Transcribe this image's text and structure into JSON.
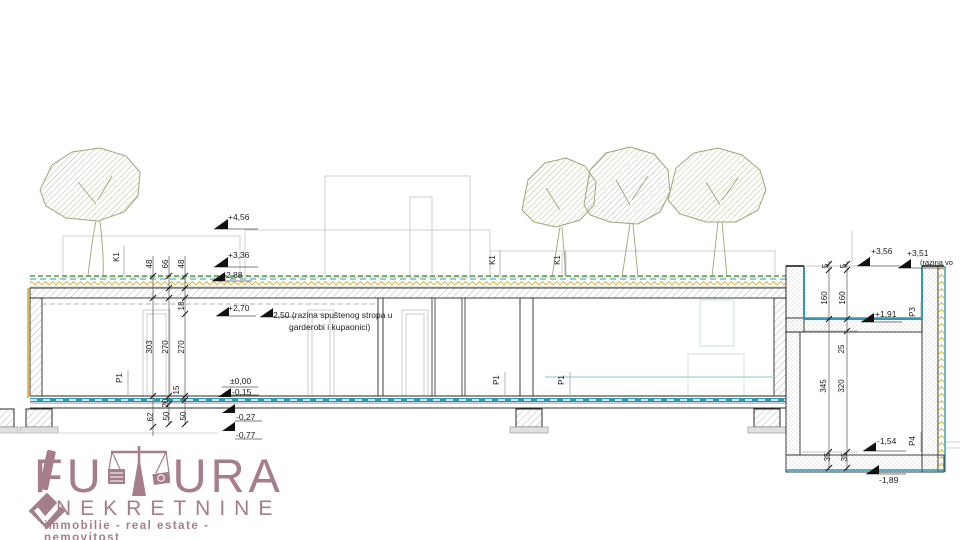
{
  "drawing": {
    "levels": {
      "p456": "+4,56",
      "p336": "+3,36",
      "p288": "+2,88",
      "p270": "+2,70",
      "zero": "±0,00",
      "m015": "-0,15",
      "m027": "-0,27",
      "m077": "-0,77",
      "p356": "+3,56",
      "p351": "+3,51",
      "p191": "+1,91",
      "m154": "-1,54",
      "m189": "-1,89"
    },
    "notes": {
      "ceiling1": "+2,50 (razina spuštenog stropa u",
      "ceiling2": "garderobi i kupaonici)",
      "water": "(razina vo"
    },
    "dims": {
      "d48a": "48",
      "d66": "66",
      "d48b": "48",
      "d18": "18",
      "d303": "303",
      "d270a": "270",
      "d270b": "270",
      "d15": "15",
      "d20": "20",
      "d62": "62",
      "d50a": "50",
      "d50b": "50",
      "d5a": "5",
      "d5b": "5",
      "d160a": "160",
      "d160b": "160",
      "d25": "25",
      "d345": "345",
      "d320": "320",
      "d35a": "35",
      "d35b": "35"
    },
    "tags": {
      "k1": "K1",
      "p1": "P1",
      "p3": "P3",
      "p4": "P4"
    }
  },
  "logo": {
    "word_left": "FU",
    "word_right": "URA",
    "line2": "NEKRETNINE",
    "tagline": "immobilie - real estate - nemovitost"
  },
  "colors": {
    "teal": "#2f98ad",
    "green": "#5d9b4a",
    "yellow": "#d9b84a",
    "tree": "#9aa878",
    "logo": "#a67e8a",
    "ink": "#1c1c1c"
  }
}
